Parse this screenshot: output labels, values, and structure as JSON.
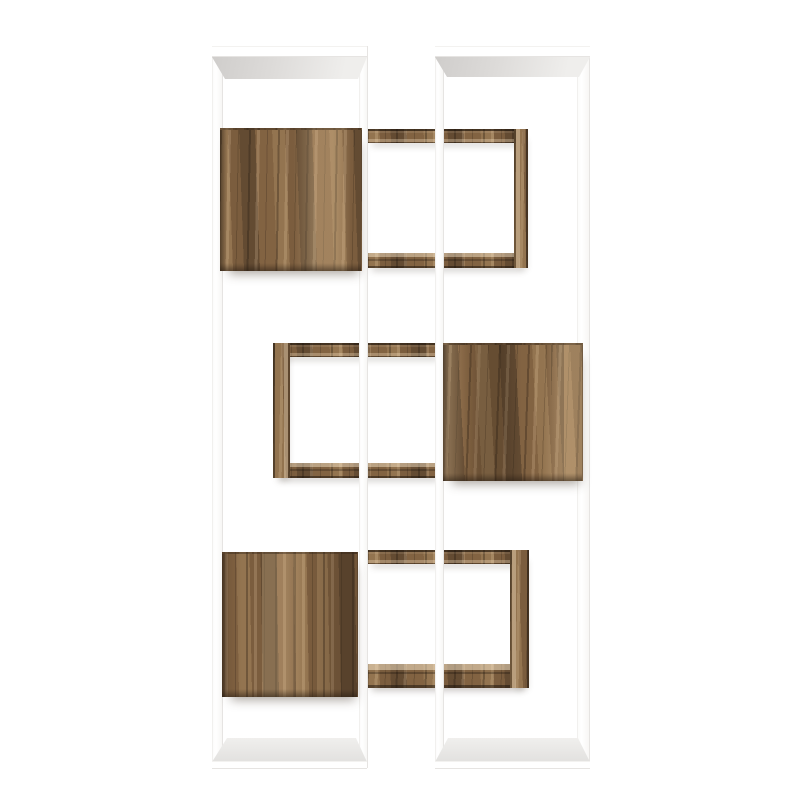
{
  "image": {
    "subject": "bookcase-product-photo",
    "materials": {
      "frame": "white",
      "shelving": "walnut"
    }
  },
  "colors": {
    "background": "#ffffff",
    "frame_white": "#ffffff",
    "frame_outline": "#e6e4e2",
    "frame_underside": "#d6d4d2",
    "frame_floor": "#e8e7e5",
    "walnut_base": "#7b5d3e",
    "walnut_light": "#a3835b",
    "walnut_mid": "#8a6a47",
    "walnut_dark": "#5a452f",
    "walnut_edge_dark": "#3c2d1f"
  }
}
